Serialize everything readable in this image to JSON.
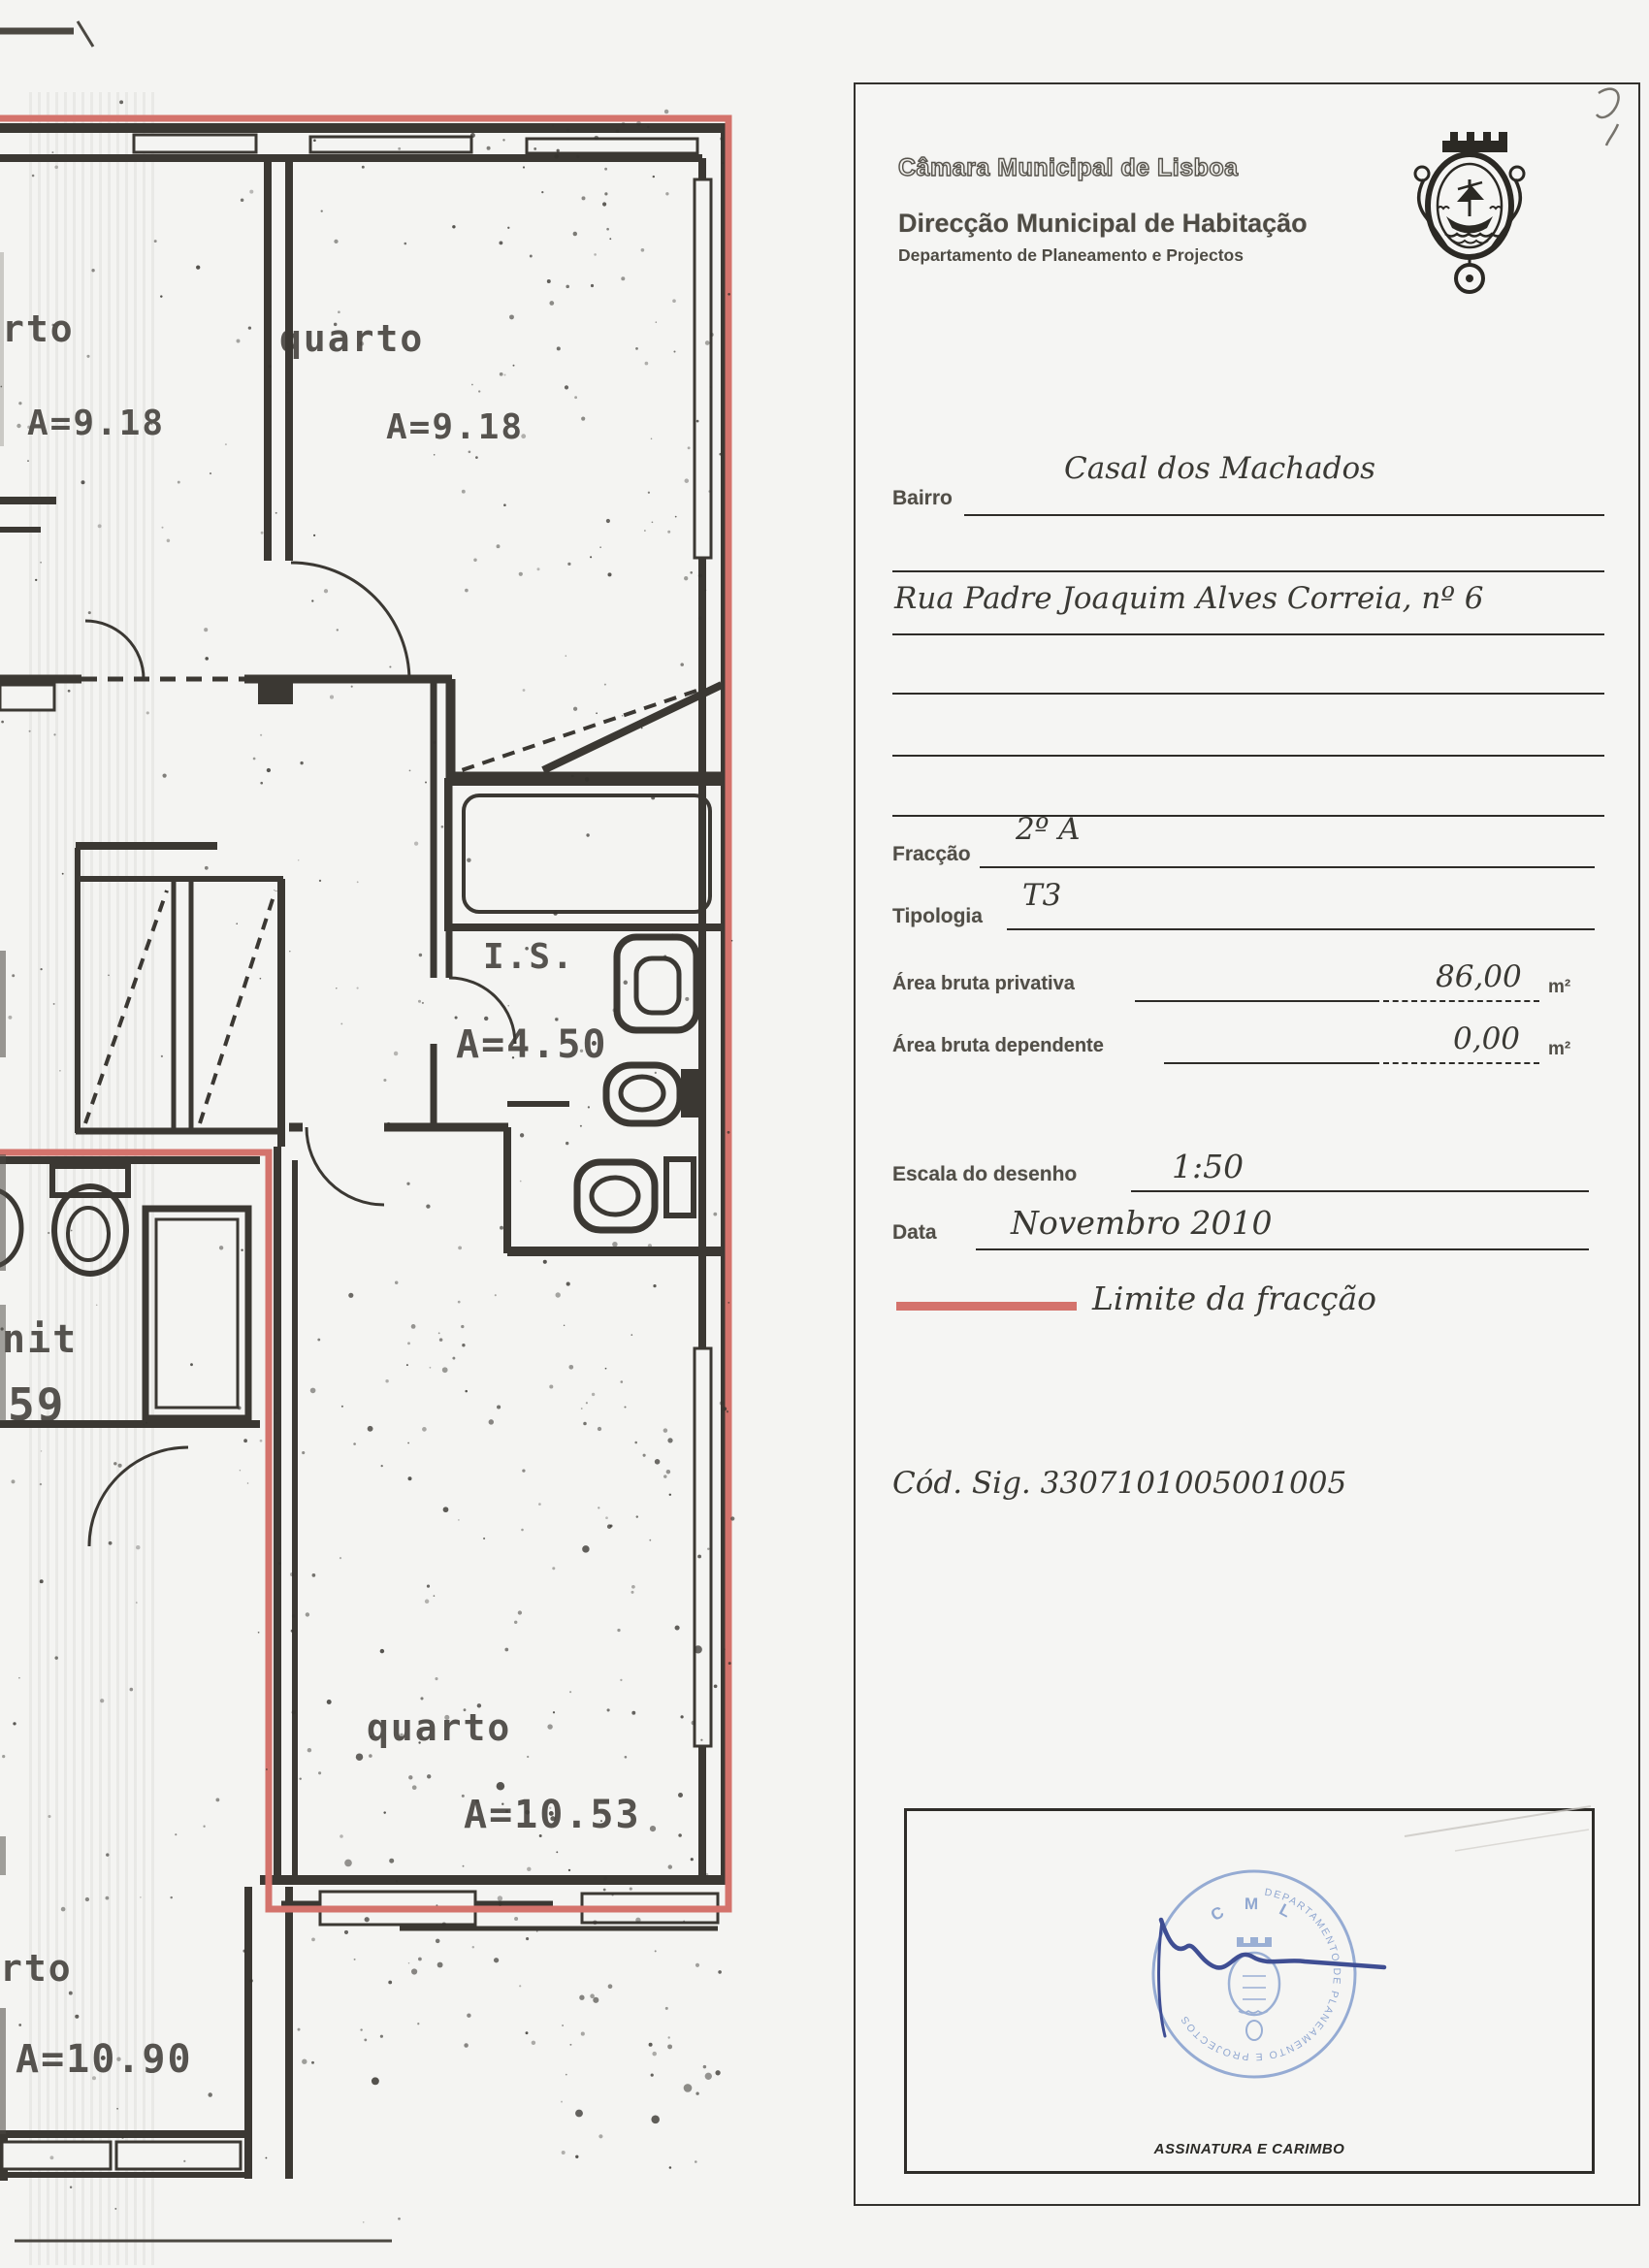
{
  "header": {
    "org": "Câmara Municipal de Lisboa",
    "direction": "Direcção Municipal de Habitação",
    "department": "Departamento de Planeamento e Projectos",
    "logo": "lisbon-coat-of-arms"
  },
  "form": {
    "bairro_label": "Bairro",
    "bairro_value": "Casal dos Machados",
    "address_value": "Rua Padre Joaquim Alves Correia, nº 6",
    "fraccao_label": "Fracção",
    "fraccao_value": "2º A",
    "tipologia_label": "Tipologia",
    "tipologia_value": "T3",
    "area_privativa_label": "Área bruta privativa",
    "area_privativa_value": "86,00",
    "area_privativa_unit": "m²",
    "area_dependente_label": "Área bruta dependente",
    "area_dependente_value": "0,00",
    "area_dependente_unit": "m²",
    "escala_label": "Escala do desenho",
    "escala_value": "1:50",
    "data_label": "Data",
    "data_value": "Novembro 2010",
    "legend_label": "Limite da fracção",
    "cod_sig": "Cód. Sig. 3307101005001005"
  },
  "signature_box": {
    "caption": "ASSINATURA E CARIMBO",
    "stamp_top": "C M L",
    "stamp_ring": "DEPARTAMENTO DE PLANEAMENTO E PROJECTOS"
  },
  "floor_plan": {
    "scale": "1:50",
    "rooms": {
      "top_left": {
        "label": "rto",
        "area": "A=9.18"
      },
      "top": {
        "label": "quarto",
        "area": "A=9.18"
      },
      "is": {
        "label": "I.S.",
        "area": "A=4.50"
      },
      "bottom": {
        "label": "quarto",
        "area": "A=10.53"
      },
      "bottom_left": {
        "label": "rto",
        "area": "A=10.90"
      },
      "left_partial": {
        "label": "nit",
        "area": "59"
      }
    }
  },
  "colors": {
    "fraction_limit": "#d4736c",
    "plan_ink": "#3b3833",
    "stamp_blue": "#8ba3cf",
    "signature_blue": "#3f4e93"
  }
}
